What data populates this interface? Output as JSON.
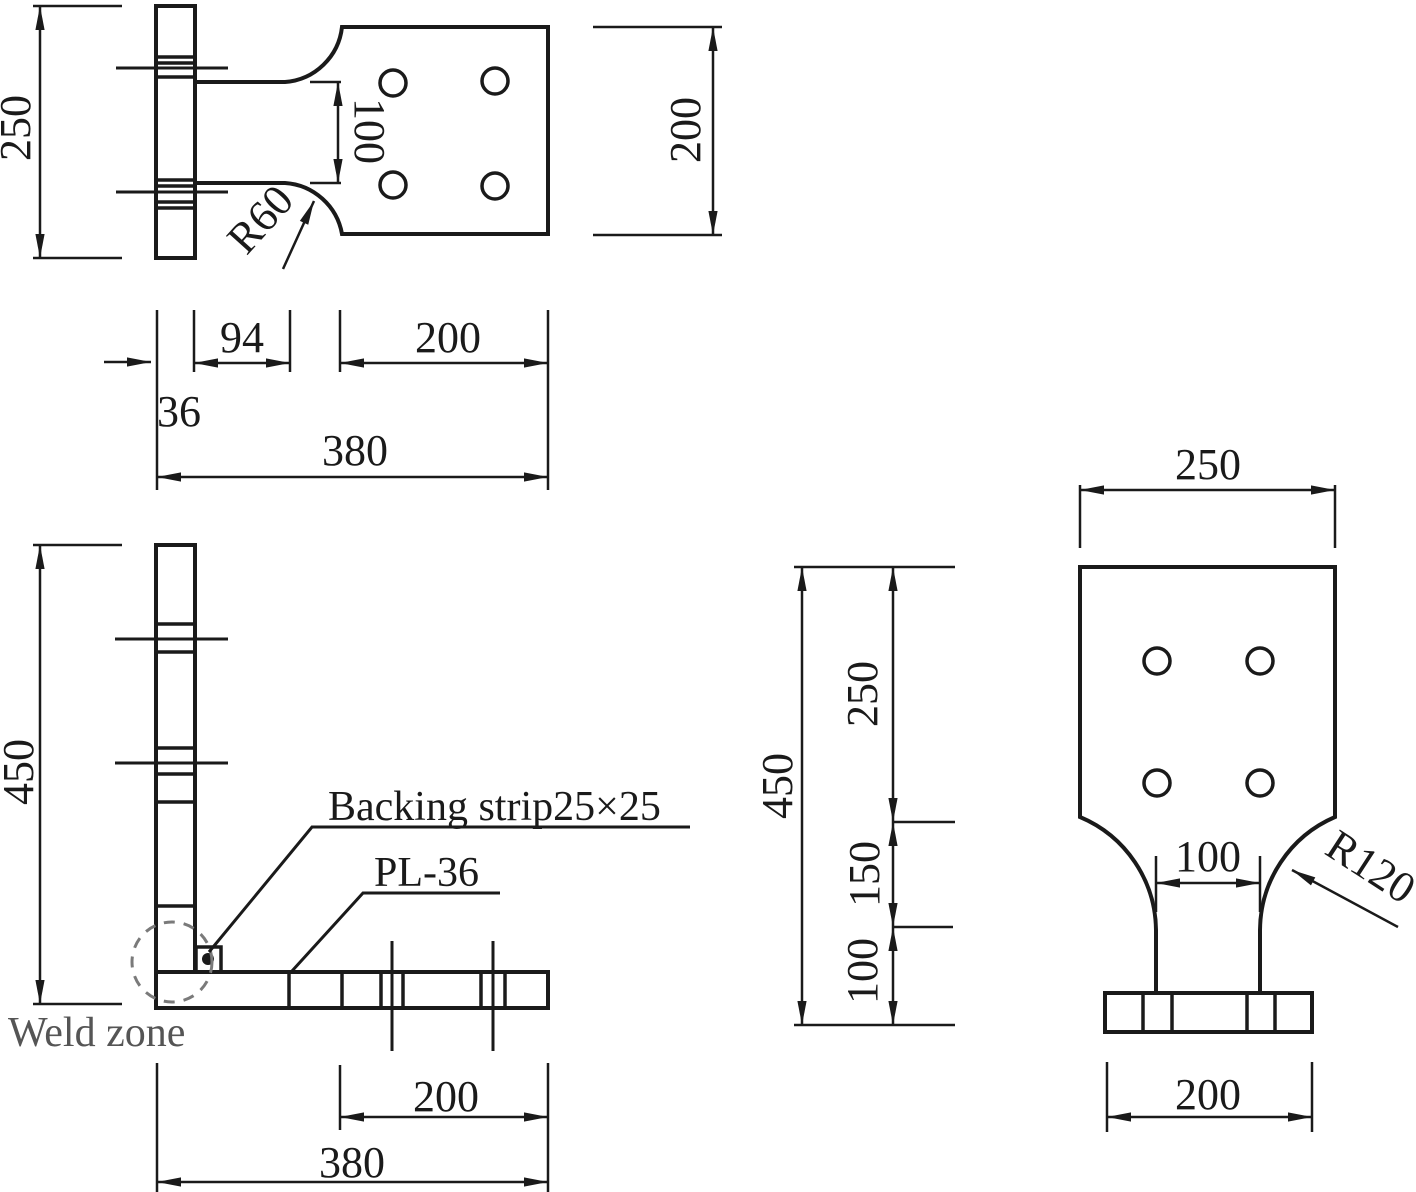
{
  "figure": {
    "kind": "engineering drawing - welded plate specimen, orthographic views",
    "colors": {
      "line": "#1a1a1a",
      "muted_text": "#555555"
    },
    "labels": {
      "backing_strip": "Backing strip25×25",
      "plate": "PL-36",
      "weld_zone": "Weld zone"
    },
    "dims": {
      "top": {
        "flange_length": "250",
        "neck": "100",
        "fillet": "R60",
        "plate_depth": "200",
        "bolt_offset": "94",
        "thickness": "36",
        "bolt_span": "200",
        "length": "380"
      },
      "front": {
        "height": "450",
        "bolt_span": "200",
        "length": "380"
      },
      "chain": {
        "total": "450",
        "upper": "250",
        "middle": "150",
        "lower": "100"
      },
      "end": {
        "width": "250",
        "neck": "100",
        "fillet": "R120",
        "base": "200"
      }
    }
  }
}
